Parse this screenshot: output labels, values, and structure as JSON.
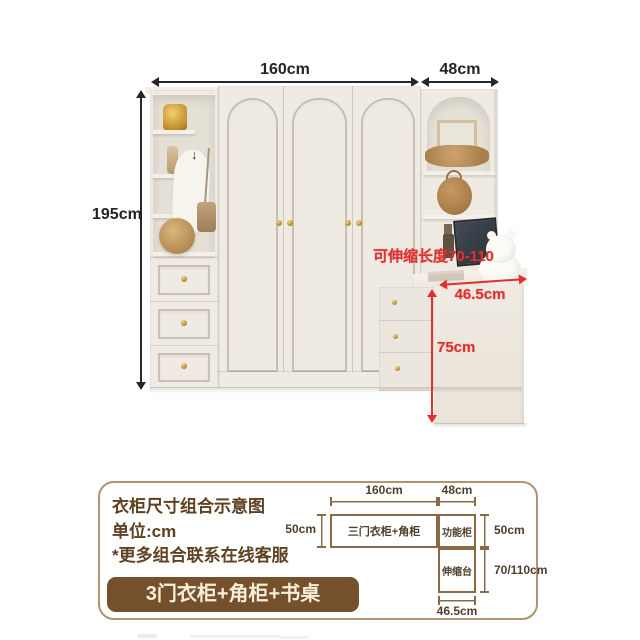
{
  "photo": {
    "dims": {
      "width_main": "160cm",
      "width_side": "48cm",
      "height": "195cm"
    },
    "annotations": {
      "extendable_note": "可伸缩长度70-110",
      "desk_depth": "46.5cm",
      "desk_height": "75cm"
    }
  },
  "card": {
    "title": "衣柜尺寸组合示意图",
    "unit": "单位:cm",
    "note": "*更多组合联系在线客服",
    "button": "3门衣柜+角柜+书桌",
    "diagram": {
      "width_main": "160cm",
      "width_side": "48cm",
      "height_left": "50cm",
      "height_side": "50cm",
      "height_desk": "70/110cm",
      "width_desk": "46.5cm",
      "label_wardrobe": "三门衣柜+角柜",
      "label_side": "功能柜",
      "label_desk": "伸缩台"
    }
  },
  "icons": {
    "hook_arrow": "↓"
  },
  "colors": {
    "accent_red": "#e12f2f",
    "brand_brown": "#74512c",
    "diagram_line_brown": "#8a6a45",
    "text_brown": "#5d4121",
    "dim_black": "#26262b",
    "cabinet_cream": "#efeae2"
  }
}
